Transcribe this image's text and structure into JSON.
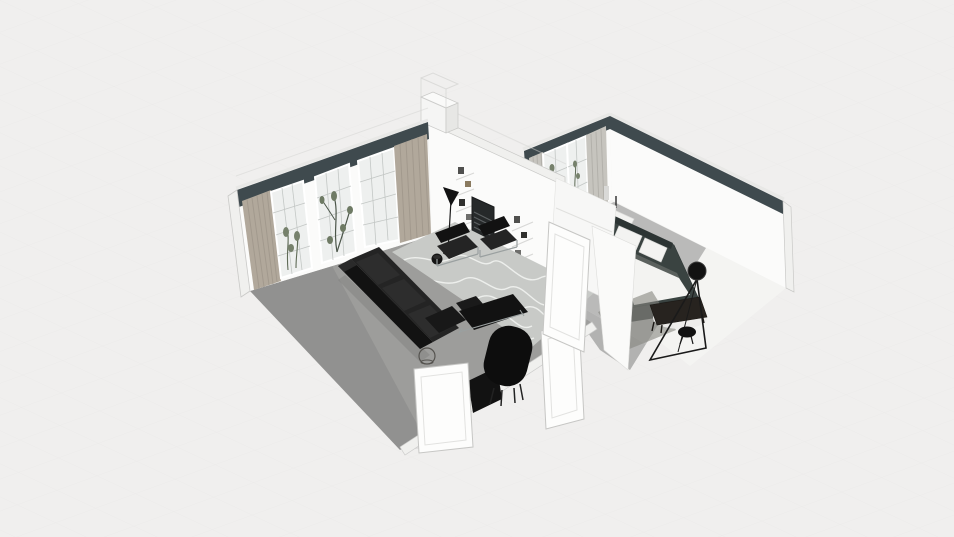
{
  "scene": {
    "type": "3d-floorplan-dollhouse-render",
    "camera": "axonometric top-down cutaway",
    "description": "Two-room apartment render: living room with black leather furniture and built-in fireplace wall, adjoining bedroom with dark platform bed"
  },
  "colors": {
    "background": "#f0efee",
    "grid_line": "#e9e8e7",
    "wall_accent": "#3f4a4e",
    "wall_white": "#fbfbfa",
    "wall_cut": "#f0f0ee",
    "wall_outline": "#c9c9c7",
    "floor_living": "#9d9d9b",
    "rug_living": "#c8cac7",
    "rug_pattern": "#f0f1ef",
    "floor_bedroom": "#f4f4f2",
    "floor_bedroom_shadow": "#b4b4b2",
    "curtain_living": "#b1a89b",
    "curtain_fold": "#9c9488",
    "curtain_bedroom": "#c6c4be",
    "glass": "#eef0ef",
    "plant": "#76816c",
    "furniture_black": "#121212",
    "furniture_black_light": "#242424",
    "chrome": "#9aa0a0",
    "bed_platform": "#3a4341",
    "bedding": "#f3f3f1",
    "blanket": "#5f6562",
    "wood": "#7a5c3f",
    "door_white": "#fdfdfc"
  },
  "rooms": [
    {
      "id": "living-room",
      "label": "Living Room",
      "objects": [
        "accent-wall-band",
        "french-window",
        "french-window",
        "french-window",
        "curtain-panel",
        "curtain-panel",
        "bookshelf-wall",
        "wall-art",
        "fireplace",
        "chimney",
        "floor-lamp",
        "wassily-armchair",
        "wassily-armchair",
        "black-leather-sofa",
        "wire-side-table",
        "barcelona-chaise",
        "black-armchair",
        "media-cabinet",
        "patterned-area-rug",
        "open-door",
        "open-door"
      ]
    },
    {
      "id": "bedroom",
      "label": "Bedroom",
      "objects": [
        "accent-wall-band",
        "french-window",
        "french-window",
        "curtain-panel",
        "curtain-panel",
        "double-bed",
        "pillows",
        "duvet",
        "console-table",
        "dark-dresser",
        "foot-bench",
        "round-rug",
        "arc-floor-lamp",
        "round-stool",
        "area-rug",
        "open-door"
      ]
    }
  ]
}
